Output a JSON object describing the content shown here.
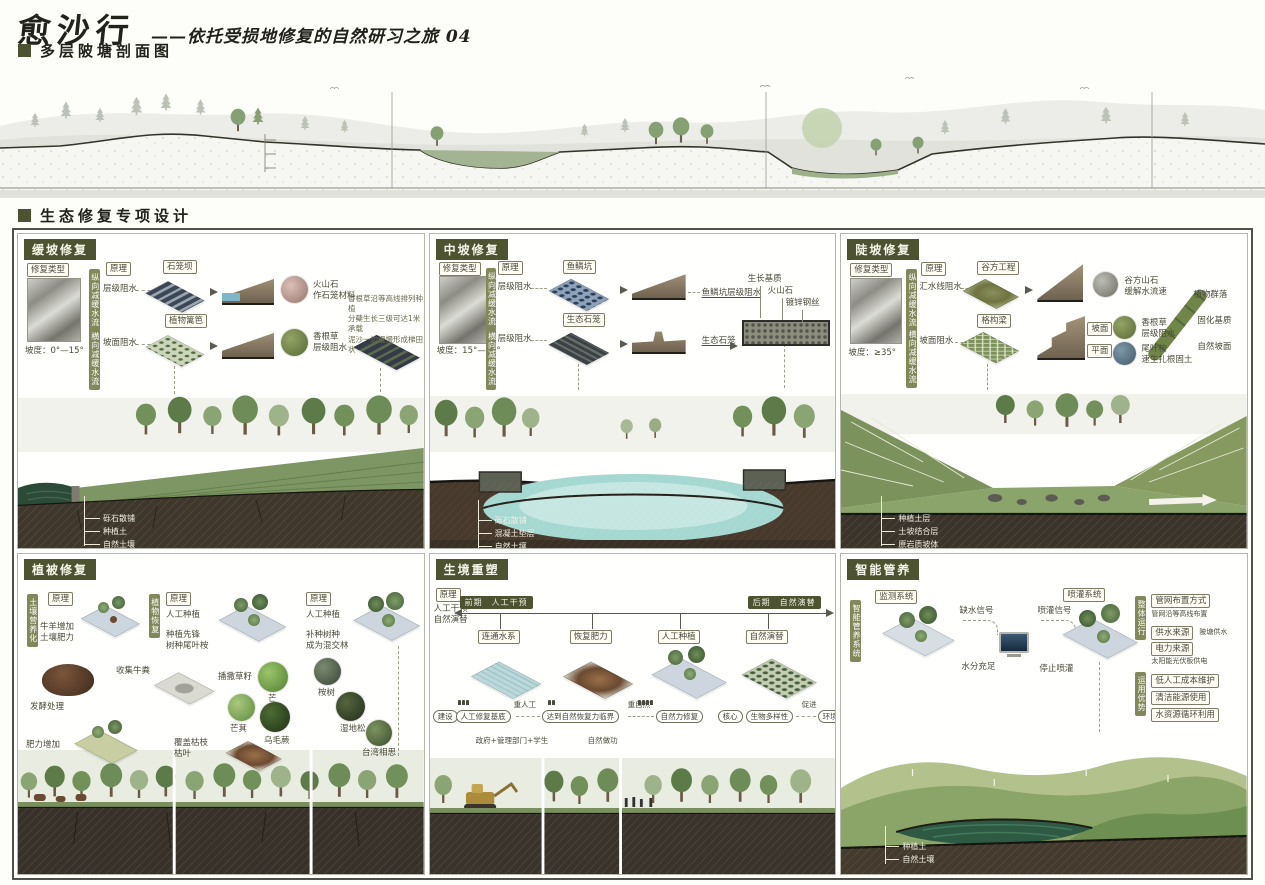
{
  "header": {
    "title": "愈沙行",
    "subtitle": "——依托受损地修复的自然研习之旅 04",
    "section1": "多层陂塘剖面图",
    "section2": "生态修复专项设计"
  },
  "overview": {
    "layers": [
      "种植土层",
      "自然土壤",
      "原岩质坡体"
    ],
    "zones": [
      "源头修复区",
      "多层陂塘区",
      "湿地景观区",
      "认领种植区"
    ]
  },
  "p1": {
    "tag": "缓坡修复",
    "type_label": "修复类型",
    "slope": "坡度：0°—15°",
    "principle_label": "原理",
    "vtag1": "纵向减缓水流",
    "vtag2": "横向减缓水流",
    "r1_label": "层级阻水",
    "r1_box": "石笼坝",
    "r1_mat": "火山石\n作石笼材料",
    "r2_label": "坡面阻水",
    "r2_box": "植物篱笆",
    "r2_mat": "香根草\n层级阻水",
    "note": "香根草沿等高线排列种植\n分蘖生长三级可达1米 承载\n泥沙一边慢慢形成梯田状",
    "soil": [
      "砾石散铺",
      "种植土",
      "自然土壤"
    ]
  },
  "p2": {
    "tag": "中坡修复",
    "type_label": "修复类型",
    "slope": "坡度：15°—35°",
    "principle_label": "原理",
    "vtag1": "纵向减缓水流",
    "vtag2": "横向减缓水流",
    "r1_label": "层级阻水",
    "r1_box": "鱼鳞坑",
    "r1_result": "鱼鳞坑层级阻水",
    "r2_label": "层级阻水",
    "r2_box": "生态石笼",
    "r2_result": "生态石笼",
    "details": [
      "生长基质",
      "火山石",
      "镀锌钢丝"
    ],
    "soil": [
      "砾石散铺",
      "混凝土垫层",
      "自然土壤"
    ]
  },
  "p3": {
    "tag": "陡坡修复",
    "type_label": "修复类型",
    "slope": "坡度：≥35°",
    "principle_label": "原理",
    "vtag1": "纵向减缓水流",
    "vtag2": "横向减缓水流",
    "r1_label": "汇水线阻水",
    "r1_box": "谷方工程",
    "r1_mat": "谷方山石\n缓解水流速",
    "r2_label": "坡面阻水",
    "r2_box": "格构梁",
    "s1": "坡面",
    "s2": "平面",
    "mat1": "香根草\n层级阻水",
    "mat2": "尾叶桉\n速生扎根固土",
    "right": [
      "植物群落",
      "固化基质",
      "自然坡面"
    ],
    "soil": [
      "种植土层",
      "土坡结合层",
      "原岩质坡体"
    ]
  },
  "p4": {
    "tag": "植被修复",
    "vtag1": "土壤营养化",
    "vtag2": "植物恢复",
    "principle_label": "原理",
    "g1_text": "牛羊增加\n土壤肥力",
    "g1_s1": "收集牛粪",
    "g1_s2": "发酵处理",
    "g1_s3": "肥力增加",
    "g2_t": "人工种植",
    "g2_sub": "种植先锋\n树种尾叶桉",
    "g2_seed": "播撒草籽",
    "plants1": [
      "芒",
      "芒萁",
      "乌毛蕨"
    ],
    "g3_t": "人工种植",
    "g3_sub": "补种树种\n成为混交林",
    "plants2": [
      "桉树",
      "湿地松",
      "台湾相思"
    ],
    "mulch": "覆盖枯枝\n枯叶"
  },
  "p5": {
    "tag": "生境重塑",
    "principle_label": "原理",
    "ptext": "人工干预\n自然演替",
    "tl_start": "前期　人工干预",
    "tl_end": "后期　自然演替",
    "nodes": [
      "连通水系",
      "恢复肥力",
      "人工种植",
      "自然演替"
    ],
    "f0": "建设",
    "f1": "人工修复基底",
    "a1": "重人工",
    "f2": "达到自然恢复力临界",
    "a2": "重自然",
    "f3": "自然力修复",
    "f4": "核心",
    "f5": "生物多样性",
    "a3": "促进",
    "f6": "环境韧性",
    "sub1": "政府+管理部门+学生",
    "sub2": "自然做功"
  },
  "p6": {
    "tag": "智能管养",
    "vtag": "智能管养系统",
    "monitor": "监测系统",
    "spray": "喷灌系统",
    "sig1": "缺水信号",
    "sig2": "水分充足",
    "sig3": "喷灌信号",
    "sig4": "停止喷灌",
    "run_title": "整体运行",
    "run": [
      {
        "k": "管网布置方式",
        "v": "管网沿等高线布置"
      },
      {
        "k": "供水来源",
        "v": "陂塘供水"
      },
      {
        "k": "电力来源",
        "v": "太阳能光伏板供电"
      }
    ],
    "adv_title": "运用优势",
    "adv": [
      "低人工成本维护",
      "清洁能源使用",
      "水资源循环利用"
    ],
    "soil": [
      "种植土",
      "自然土壤"
    ]
  },
  "colors": {
    "accent": "#4d5330",
    "vtag": "#83885a",
    "pond_cyan": "#a6d8d2",
    "pond_dark": "#2e5a43"
  }
}
